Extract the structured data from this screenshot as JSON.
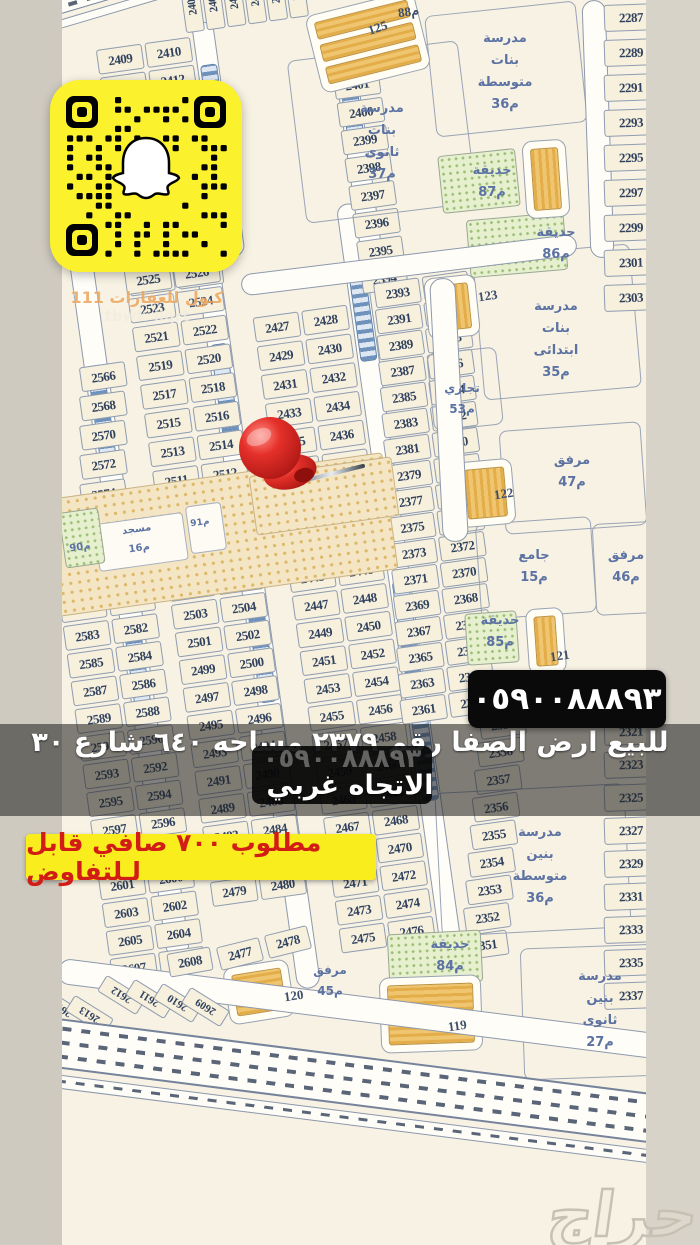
{
  "listing": {
    "phone": "٠٥٩٠٠٨٨٨٩٣",
    "ghost_phone": "٠٥٩٠٠٨٨٨٩٣",
    "title_line1": "للبيع ارض الصفا رقم ٢٣٧٩ مساحه ٦٤٠ شارع ٣٠",
    "title_line2": "الاتجاه غربي",
    "price": "مطلوب ٧٠٠ صافي قابل لـلتفاوض"
  },
  "watermark": {
    "line1": "كـول للعقارات 111",
    "line2": "tbwk_llqrt"
  },
  "branding": {
    "haraj": "حراج"
  },
  "colors": {
    "snap_yellow": "#fbf22d",
    "price_yellow": "#f9ed1e",
    "price_red": "#d11d15",
    "pin_red": "#d9261f",
    "banner_black": "#0a0a0a"
  },
  "map": {
    "blocks": [
      {
        "x": 430,
        "y": 8,
        "w": 150,
        "h": 120,
        "r": -6
      },
      {
        "x": 296,
        "y": 50,
        "w": 170,
        "h": 162,
        "r": -7
      },
      {
        "x": 478,
        "y": 250,
        "w": 156,
        "h": 142,
        "r": -5
      },
      {
        "x": 430,
        "y": 350,
        "w": 68,
        "h": 76,
        "r": -6
      },
      {
        "x": 502,
        "y": 426,
        "w": 140,
        "h": 102,
        "r": -4
      },
      {
        "x": 478,
        "y": 520,
        "w": 114,
        "h": 94,
        "r": -4
      },
      {
        "x": 594,
        "y": 522,
        "w": 76,
        "h": 90,
        "r": -3
      },
      {
        "x": 438,
        "y": 788,
        "w": 188,
        "h": 142,
        "r": -3
      },
      {
        "x": 522,
        "y": 946,
        "w": 138,
        "h": 130,
        "r": -2
      }
    ],
    "dotted_bands": [
      {
        "x": 42,
        "y": 476,
        "w": 348,
        "h": 116,
        "r": -8
      },
      {
        "x": 252,
        "y": 466,
        "w": 142,
        "h": 58,
        "r": -8
      }
    ],
    "white_rects": [
      {
        "x": 96,
        "y": 518,
        "w": 88,
        "h": 46,
        "r": -8
      },
      {
        "x": 188,
        "y": 504,
        "w": 34,
        "h": 46,
        "r": -8
      }
    ],
    "parks": [
      {
        "x": 440,
        "y": 152,
        "w": 76,
        "h": 56,
        "r": -6
      },
      {
        "x": 468,
        "y": 216,
        "w": 96,
        "h": 56,
        "r": -5
      },
      {
        "x": 466,
        "y": 612,
        "w": 50,
        "h": 50,
        "r": -4
      },
      {
        "x": 388,
        "y": 932,
        "w": 92,
        "h": 50,
        "r": -3
      },
      {
        "x": 62,
        "y": 510,
        "w": 38,
        "h": 54,
        "r": -8
      }
    ],
    "buildings": [
      {
        "x": 312,
        "y": 2,
        "w": 112,
        "h": 80,
        "r": -14,
        "o": "h",
        "n": 3
      },
      {
        "x": 524,
        "y": 140,
        "w": 44,
        "h": 78,
        "r": -4,
        "o": "v",
        "n": 1
      },
      {
        "x": 426,
        "y": 276,
        "w": 52,
        "h": 62,
        "r": -6,
        "o": "v",
        "n": 1
      },
      {
        "x": 458,
        "y": 460,
        "w": 56,
        "h": 66,
        "r": -5,
        "o": "v",
        "n": 1
      },
      {
        "x": 527,
        "y": 608,
        "w": 38,
        "h": 66,
        "r": -4,
        "o": "v",
        "n": 1
      },
      {
        "x": 226,
        "y": 963,
        "w": 66,
        "h": 58,
        "r": -9,
        "o": "h",
        "n": 1
      },
      {
        "x": 380,
        "y": 976,
        "w": 102,
        "h": 76,
        "r": -2,
        "o": "h",
        "n": 2
      }
    ],
    "streets_unrot": [
      {
        "x": 436,
        "y": 278,
        "w": 24,
        "h": 262,
        "r": -3
      },
      {
        "x": 586,
        "y": 0,
        "w": 22,
        "h": 256,
        "r": -2
      },
      {
        "x": 240,
        "y": 254,
        "w": 336,
        "h": 20,
        "r": -7
      },
      {
        "x": 56,
        "y": 996,
        "w": 610,
        "h": 24,
        "r": 7.2
      }
    ],
    "grid_streets": [
      {
        "x": 2,
        "y": 175,
        "w": 22,
        "h": 720
      },
      {
        "x": 127,
        "y": 170,
        "w": 22,
        "h": 775
      },
      {
        "x": 274,
        "y": 175,
        "w": 20,
        "h": 770
      },
      {
        "x": 156,
        "y": -25,
        "w": 20,
        "h": 235
      },
      {
        "x": 292,
        "y": 0,
        "w": 20,
        "h": 245
      }
    ],
    "grid_ladders": [
      {
        "x": 5,
        "y": 300,
        "h": 92
      },
      {
        "x": 5,
        "y": 556,
        "h": 96
      },
      {
        "x": 130,
        "y": 296,
        "h": 96
      },
      {
        "x": 130,
        "y": 556,
        "h": 100
      },
      {
        "x": 277,
        "y": 240,
        "h": 92
      },
      {
        "x": 277,
        "y": 556,
        "h": 92
      },
      {
        "x": 277,
        "y": 692,
        "h": 84
      },
      {
        "x": 159,
        "y": 18,
        "h": 82
      },
      {
        "x": 295,
        "y": 28,
        "h": 80
      }
    ],
    "plot_columns": [
      {
        "type": "vrow",
        "x": 150,
        "y": -72,
        "values": [
          "2408",
          "2407",
          "2406",
          "2405",
          "2404",
          "2403"
        ]
      },
      {
        "x": 58,
        "y": -12,
        "step": 28,
        "rows": [
          [
            "2409",
            "2410"
          ],
          [
            "2411",
            "2412"
          ],
          [
            "2413",
            "2414"
          ],
          [
            "2415",
            "2416"
          ],
          [
            "2417",
            "2418"
          ],
          [
            "2419",
            "2420"
          ],
          [
            "2421",
            "2422"
          ],
          [
            "2423",
            "2424"
          ],
          [
            "2425",
            "2426"
          ]
        ]
      },
      {
        "x": 240,
        "y": 18,
        "step": 28,
        "single": true,
        "rows": [
          "2402",
          "2401",
          "2400",
          "2399",
          "2398",
          "2397",
          "2396",
          "2395",
          "2394"
        ]
      },
      {
        "x": -52,
        "y": 300,
        "step": 29,
        "dx": -4,
        "single": true,
        "rows": [
          "2566",
          "2568",
          "2570",
          "2572",
          "2574",
          "2576"
        ]
      },
      {
        "x": 55,
        "y": 210,
        "step": 29,
        "rows": [
          [
            "2525",
            "2526"
          ],
          [
            "2523",
            "2524"
          ],
          [
            "2521",
            "2522"
          ],
          [
            "2519",
            "2520"
          ],
          [
            "2517",
            "2518"
          ],
          [
            "2515",
            "2516"
          ],
          [
            "2513",
            "2514"
          ],
          [
            "2511",
            "2512"
          ],
          [
            "2509",
            "2510"
          ]
        ]
      },
      {
        "x": 176,
        "y": 275,
        "step": 29,
        "rows": [
          [
            "2427",
            "2428"
          ],
          [
            "2429",
            "2430"
          ],
          [
            "2431",
            "2432"
          ],
          [
            "2433",
            "2434"
          ],
          [
            "2435",
            "2436"
          ],
          [
            "2437",
            "2438"
          ],
          [
            "2439",
            "2440"
          ],
          [
            "2441",
            "2442"
          ]
        ]
      },
      {
        "x": -55,
        "y": 498,
        "step": 28,
        "rows": [
          [
            "2579",
            "2578"
          ],
          [
            "2581",
            "2580"
          ],
          [
            "2583",
            "2582"
          ],
          [
            "2585",
            "2584"
          ],
          [
            "2587",
            "2586"
          ],
          [
            "2589",
            "2588"
          ],
          [
            "2591",
            "2590"
          ],
          [
            "2593",
            "2592"
          ],
          [
            "2595",
            "2594"
          ],
          [
            "2597",
            "2596"
          ],
          [
            "2599",
            "2598"
          ],
          [
            "2601",
            "2600"
          ],
          [
            "2603",
            "2602"
          ],
          [
            "2605",
            "2604"
          ],
          [
            "2607",
            "2606"
          ]
        ]
      },
      {
        "x": 55,
        "y": 492,
        "step": 28,
        "rows": [
          [
            "2507",
            "2508"
          ],
          [
            "2505",
            "2506"
          ],
          [
            "2503",
            "2504"
          ],
          [
            "2501",
            "2502"
          ],
          [
            "2499",
            "2500"
          ],
          [
            "2497",
            "2498"
          ],
          [
            "2495",
            "2496"
          ],
          [
            "2493",
            "2494"
          ],
          [
            "2491",
            "2490"
          ],
          [
            "2489",
            "2488"
          ],
          [
            "2483",
            "2484"
          ],
          [
            "2481",
            "2482"
          ],
          [
            "2479",
            "2480"
          ]
        ]
      },
      {
        "x": 176,
        "y": 500,
        "step": 28,
        "rows": [
          [
            "2443",
            "2444"
          ],
          [
            "2445",
            "2446"
          ],
          [
            "2447",
            "2448"
          ],
          [
            "2449",
            "2450"
          ],
          [
            "2451",
            "2452"
          ],
          [
            "2453",
            "2454"
          ],
          [
            "2455",
            "2456"
          ],
          [
            "2457",
            "2458"
          ],
          [
            "2459",
            "2460"
          ],
          [
            "2465",
            "2466"
          ],
          [
            "2467",
            "2468"
          ],
          [
            "2469",
            "2470"
          ],
          [
            "2471",
            "2472"
          ],
          [
            "2473",
            "2474"
          ],
          [
            "2475",
            "2476"
          ]
        ]
      },
      {
        "x": 300,
        "y": 258,
        "step": 26,
        "dx": -2,
        "rows": [
          [
            "2393",
            "2392"
          ],
          [
            "2391",
            "2390"
          ],
          [
            "2389",
            "2388"
          ],
          [
            "2387",
            "2386"
          ],
          [
            "2385",
            "2384"
          ],
          [
            "2383",
            "2382"
          ],
          [
            "2381",
            "2380"
          ],
          [
            "2379",
            "2378"
          ],
          [
            "2377",
            "2376"
          ],
          [
            "2375",
            "2374"
          ],
          [
            "2373",
            "2372"
          ],
          [
            "2371",
            "2370"
          ],
          [
            "2369",
            "2368"
          ],
          [
            "2367",
            "2366"
          ],
          [
            "2365",
            "2364"
          ],
          [
            "2363",
            "2362"
          ],
          [
            "2361",
            "2360"
          ]
        ]
      },
      {
        "x": 295,
        "y": 700,
        "step": 27,
        "dx": -6,
        "single": true,
        "rows": [
          "2359",
          "2358",
          "2357",
          "2356",
          "2355",
          "2354",
          "2353",
          "2352",
          "2351"
        ]
      }
    ],
    "right_columns": [
      {
        "x": 604,
        "y": 4,
        "step": 35,
        "values": [
          "2287",
          "2289",
          "2291",
          "2293",
          "2295",
          "2297",
          "2299",
          "2301",
          "2303"
        ]
      },
      {
        "x": 604,
        "y": 718,
        "step": 33,
        "values": [
          "2321",
          "2323",
          "2325",
          "2327",
          "2329",
          "2331",
          "2333",
          "2335",
          "2337"
        ]
      }
    ],
    "loose_cells": [
      {
        "v": "2608",
        "x": 168,
        "y": 950,
        "r": -10
      },
      {
        "v": "2477",
        "x": 218,
        "y": 942,
        "r": -14
      },
      {
        "v": "2478",
        "x": 266,
        "y": 930,
        "r": -14
      }
    ],
    "fan_cells": [
      {
        "v": "2614",
        "x": 52,
        "y": 986
      },
      {
        "v": "2613",
        "x": 80,
        "y": 992
      },
      {
        "v": "2612",
        "x": 112,
        "y": 972
      },
      {
        "v": "2611",
        "x": 140,
        "y": 976
      },
      {
        "v": "2610",
        "x": 168,
        "y": 980
      },
      {
        "v": "2609",
        "x": 196,
        "y": 984
      }
    ],
    "labels": [
      {
        "id": "girls-middle-school",
        "x": 505,
        "y": 28,
        "lines": [
          "مدرسة",
          "بنات",
          "متوسطة",
          "36م"
        ]
      },
      {
        "id": "girls-secondary-school",
        "x": 382,
        "y": 98,
        "lines": [
          "مدرسة",
          "بنات",
          "ثانوى",
          "37م"
        ]
      },
      {
        "id": "park-87",
        "x": 492,
        "y": 160,
        "lines": [
          "حديقة",
          "87م"
        ]
      },
      {
        "id": "park-86",
        "x": 556,
        "y": 222,
        "lines": [
          "حديقة",
          "86م"
        ]
      },
      {
        "id": "girls-elementary-school",
        "x": 556,
        "y": 296,
        "lines": [
          "مدرسة",
          "بنات",
          "ابتدائى",
          "35م"
        ]
      },
      {
        "id": "commercial-53",
        "x": 462,
        "y": 378,
        "size": 12,
        "lines": [
          "تجاري",
          "53م"
        ]
      },
      {
        "id": "facility-47",
        "x": 572,
        "y": 450,
        "lines": [
          "مرفق",
          "47م"
        ]
      },
      {
        "id": "mosque-15",
        "x": 534,
        "y": 545,
        "lines": [
          "جامع",
          "15م"
        ]
      },
      {
        "id": "facility-46",
        "x": 626,
        "y": 545,
        "lines": [
          "مرفق",
          "46م"
        ]
      },
      {
        "id": "park-85",
        "x": 500,
        "y": 610,
        "lines": [
          "حديقة",
          "85م"
        ]
      },
      {
        "id": "boys-middle-school",
        "x": 540,
        "y": 822,
        "lines": [
          "مدرسة",
          "بنين",
          "متوسطة",
          "36م"
        ]
      },
      {
        "id": "park-84",
        "x": 450,
        "y": 934,
        "lines": [
          "حديقة",
          "84م"
        ]
      },
      {
        "id": "facility-45",
        "x": 330,
        "y": 960,
        "size": 12,
        "lines": [
          "مرفق",
          "45م"
        ]
      },
      {
        "id": "boys-secondary-school",
        "x": 600,
        "y": 966,
        "lines": [
          "مدرسة",
          "بنين",
          "ثانوى",
          "27م"
        ]
      },
      {
        "id": "mosque-16",
        "x": 138,
        "y": 520,
        "size": 10,
        "rot": -8,
        "lines": [
          "مسجد",
          "16م"
        ]
      },
      {
        "id": "park-91",
        "x": 200,
        "y": 514,
        "size": 9,
        "rot": -8,
        "lines": [
          "91م"
        ]
      },
      {
        "id": "park-90",
        "x": 80,
        "y": 538,
        "size": 10,
        "rot": -8,
        "lines": [
          "90م"
        ]
      }
    ],
    "street_labels": [
      {
        "t": "88م",
        "x": 398,
        "y": 4,
        "r": -8
      },
      {
        "t": "125",
        "x": 368,
        "y": 20,
        "r": -18
      },
      {
        "t": "123",
        "x": 478,
        "y": 288,
        "r": -8
      },
      {
        "t": "122",
        "x": 494,
        "y": 486,
        "r": -8
      },
      {
        "t": "121",
        "x": 550,
        "y": 648,
        "r": -8
      },
      {
        "t": "120",
        "x": 284,
        "y": 988,
        "r": -8
      },
      {
        "t": "119",
        "x": 448,
        "y": 1018,
        "r": -8
      }
    ]
  }
}
